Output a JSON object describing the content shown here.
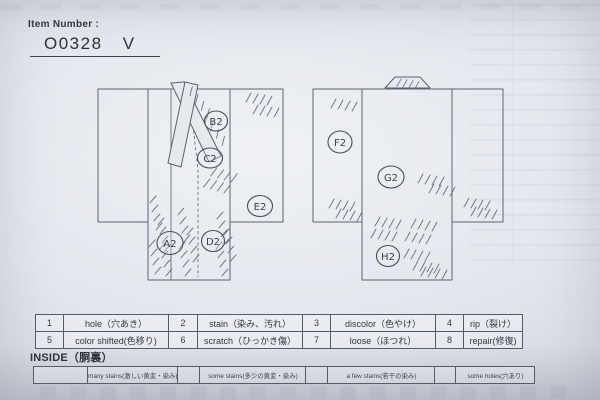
{
  "colors": {
    "paper": "#e4e7ed",
    "ink": "#5d626b",
    "text": "#32363d",
    "border": "#565b65"
  },
  "header": {
    "label": "Item Number :",
    "value": "O0328 V"
  },
  "front_diagram": {
    "name": "kimono front view",
    "marks": [
      {
        "label": "A2"
      },
      {
        "label": "B2"
      },
      {
        "label": "C2"
      },
      {
        "label": "D2"
      },
      {
        "label": "E2"
      }
    ]
  },
  "back_diagram": {
    "name": "kimono back view",
    "marks": [
      {
        "label": "F2"
      },
      {
        "label": "G2"
      },
      {
        "label": "H2"
      }
    ]
  },
  "legend_table": {
    "rows": [
      {
        "cells": [
          {
            "num": "1",
            "label": "hole（穴あき）"
          },
          {
            "num": "2",
            "label": "stain（染み、汚れ）"
          },
          {
            "num": "3",
            "label": "discolor（色やけ）"
          },
          {
            "num": "4",
            "label": "rip（裂け）"
          }
        ]
      },
      {
        "cells": [
          {
            "num": "5",
            "label": "color shifted(色移り)"
          },
          {
            "num": "6",
            "label": "scratch（ひっかき傷）"
          },
          {
            "num": "7",
            "label": "loose（ほつれ）"
          },
          {
            "num": "8",
            "label": "repair(修復)"
          }
        ]
      }
    ]
  },
  "inside_section": {
    "title": "INSIDE（胴裏）",
    "options": [
      {
        "label": "many stains(激しい黄変・染み)"
      },
      {
        "label": "some stains(多少の黄変・染み)"
      },
      {
        "label": "a few stains(若干の染み)"
      },
      {
        "label": "some holes(穴あり)"
      }
    ]
  }
}
